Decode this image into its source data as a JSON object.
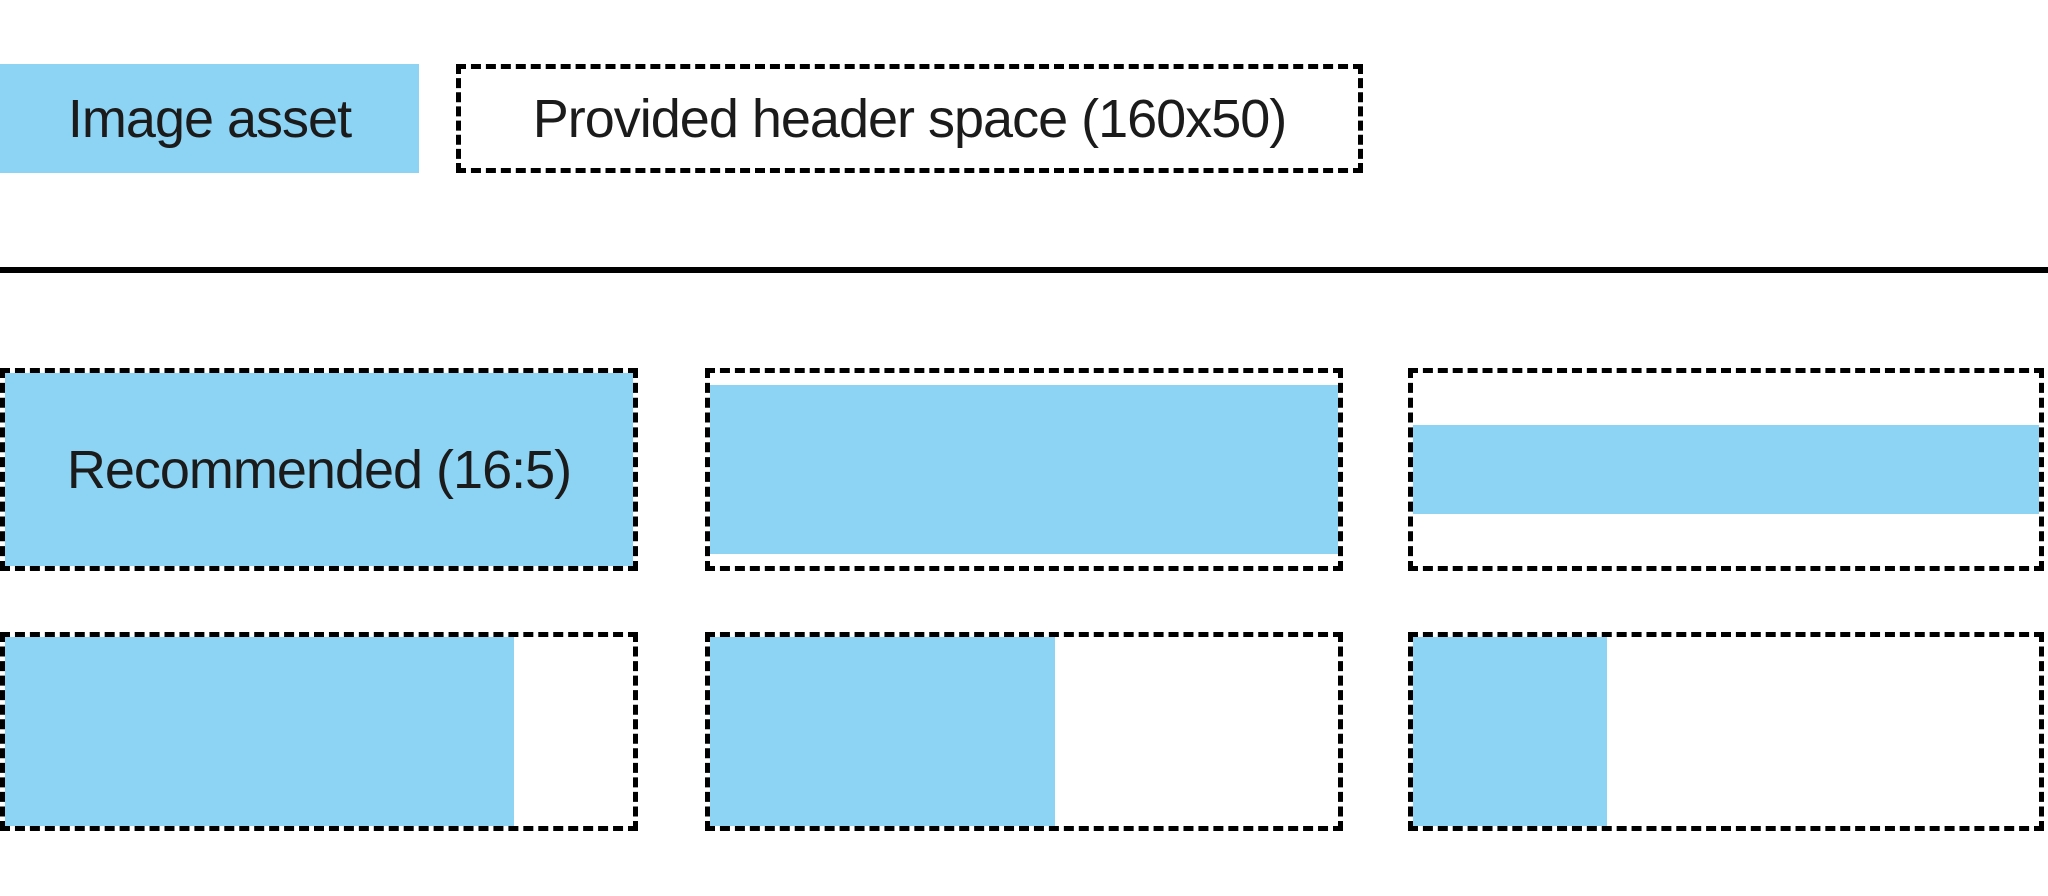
{
  "colors": {
    "asset_blue": "#8CD3F4",
    "line_black": "#000000",
    "text": "#1b1b1b",
    "background": "#ffffff"
  },
  "legend": {
    "image_asset_label": "Image asset",
    "header_space_label": "Provided header space (160x50)"
  },
  "examples": [
    {
      "name": "recommended-16-5",
      "label": "Recommended (16:5)",
      "fill": "width:100%;height:100%"
    },
    {
      "name": "wider-than-16-5-letterboxed",
      "fill": "width:100%;height:88%"
    },
    {
      "name": "much-wider-than-16-5-letterboxed",
      "fill": "width:100%;height:46%"
    },
    {
      "name": "narrower-than-16-5-pillarboxed",
      "fill": "width:81%;height:100%"
    },
    {
      "name": "much-narrower-than-16-5-pillarboxed",
      "fill": "width:55%;height:100%"
    },
    {
      "name": "narrowest-than-16-5-pillarboxed",
      "fill": "width:31%;height:100%"
    }
  ]
}
